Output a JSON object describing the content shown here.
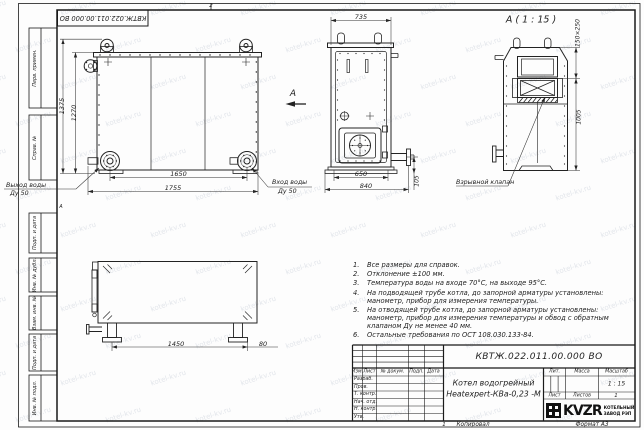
{
  "sheet": {
    "designation": "КВТЖ.022.011.00.000 ВО",
    "copied_label": "Копировал",
    "format_label": "Формат А3",
    "sheet_mark": "1",
    "zone_top": "2",
    "zone_left": "А"
  },
  "watermark": {
    "text": "kotel-kv.ru"
  },
  "border_columns": {
    "perv": "Перв. примен.",
    "sprav": "Справ. №",
    "podp1": "Подп. и дата",
    "inv_dubl": "Инв. № дубл.",
    "vzam": "Взам. инв. №",
    "podp2": "Подп. и дата",
    "inv_podl": "Инв. № подл."
  },
  "front_view": {
    "dim_h_outer": "1375",
    "dim_h_inner": "1270",
    "dim_w_inner": "1650",
    "dim_w_outer": "1755",
    "outlet_line1": "Выход воды",
    "outlet_line2": "Ду 50",
    "inlet_line1": "Вход воды",
    "inlet_line2": "Ду 50",
    "arrow_label": "А"
  },
  "side_view": {
    "dim_top": "735",
    "dim_inner": "650",
    "dim_outer": "840",
    "dim_pipe": "105"
  },
  "view_a": {
    "title": "А ( 1 : 15 )",
    "dim_vent": "150×250",
    "dim_height": "1005",
    "valve_label": "Взрывной клапан"
  },
  "bottom_view": {
    "dim_span": "1450",
    "dim_end": "80"
  },
  "notes": {
    "items": [
      {
        "num": "1.",
        "text": "Все размеры для справок."
      },
      {
        "num": "2.",
        "text": "Отклонение ±100 мм."
      },
      {
        "num": "3.",
        "text": "Температура воды на входе 70°С, на выходе 95°С."
      },
      {
        "num": "4.",
        "text": "На подводящей трубе котла, до запорной арматуры установлены:\nманометр, прибор для измерения температуры."
      },
      {
        "num": "5.",
        "text": "На отводящей трубе котла, до запорной арматуры установлены:\nманометр, прибор для измерения температуры и обвод с обратным\nклапаном Ду не менее 40 мм."
      },
      {
        "num": "6.",
        "text": "Остальные требования по ОСТ 108.030.133-84."
      }
    ]
  },
  "title_block": {
    "designation": "КВТЖ.022.011.00.000 ВО",
    "product_line1": "Котел водогрейный",
    "product_line2": "Heatexpert-КВа-0,23 -М",
    "col_izm": "Изм.",
    "col_list": "Лист",
    "col_doc": "№ докум.",
    "col_podp": "Подп.",
    "col_data": "Дата",
    "rows": [
      "Разраб.",
      "Пров.",
      "Т. контр.",
      "Нач. отд.",
      "Н. контр.",
      "Утв."
    ],
    "lit_label": "Лит.",
    "mass_label": "Масса",
    "scale_label": "Масштаб",
    "scale_value": "1 : 15",
    "sheet_label": "Лист",
    "sheets_label": "Листов",
    "sheets_value": "1",
    "logo_text": "KVZR",
    "logo_sub1": "КОТЕЛЬНЫЙ",
    "logo_sub2": "ЗАВОД РЭП"
  }
}
